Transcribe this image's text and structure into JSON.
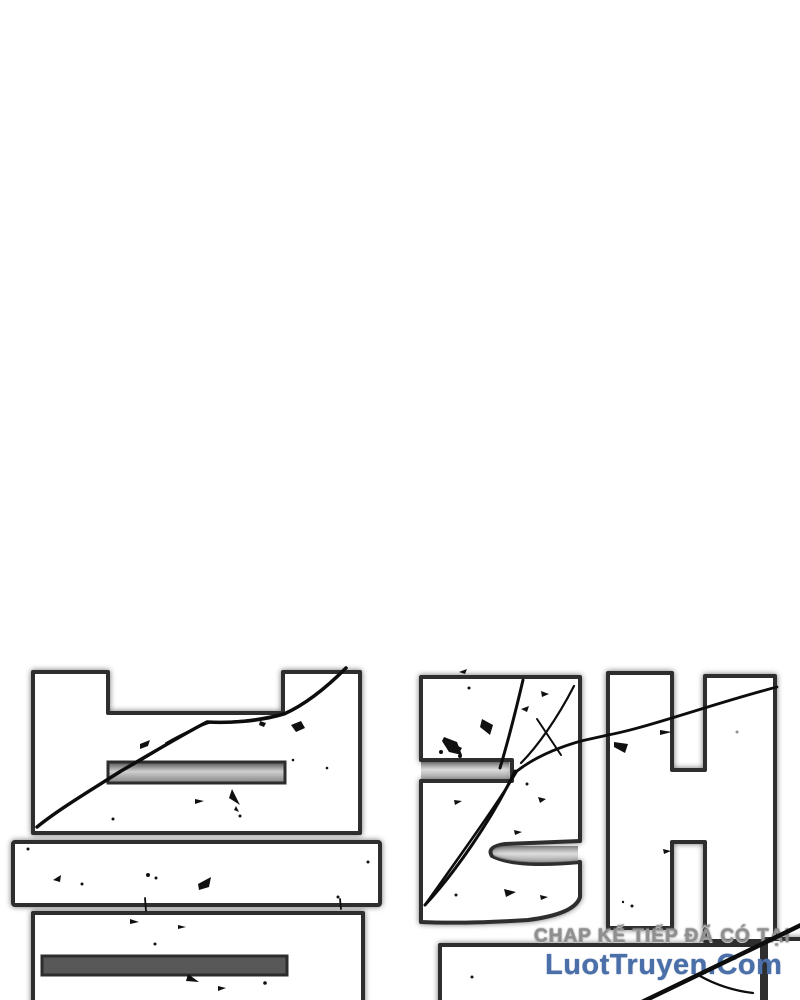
{
  "page": {
    "background_color": "#ffffff"
  },
  "artwork": {
    "depicted_text": "블랙",
    "description": "large cracked white block title lettering with black ink splatters, partially cropped at the bottom edge",
    "fill_color": "#ffffff",
    "outline_color": "#2d2d2d",
    "crack_color": "#0d0d0d"
  },
  "watermark": {
    "line1": "CHAP KẾ TIẾP ĐÃ CÓ TẠI",
    "line2": "LuotTruyen.Com",
    "line1_color": "#8f8f8f",
    "line2_color": "#4a6fa9"
  }
}
